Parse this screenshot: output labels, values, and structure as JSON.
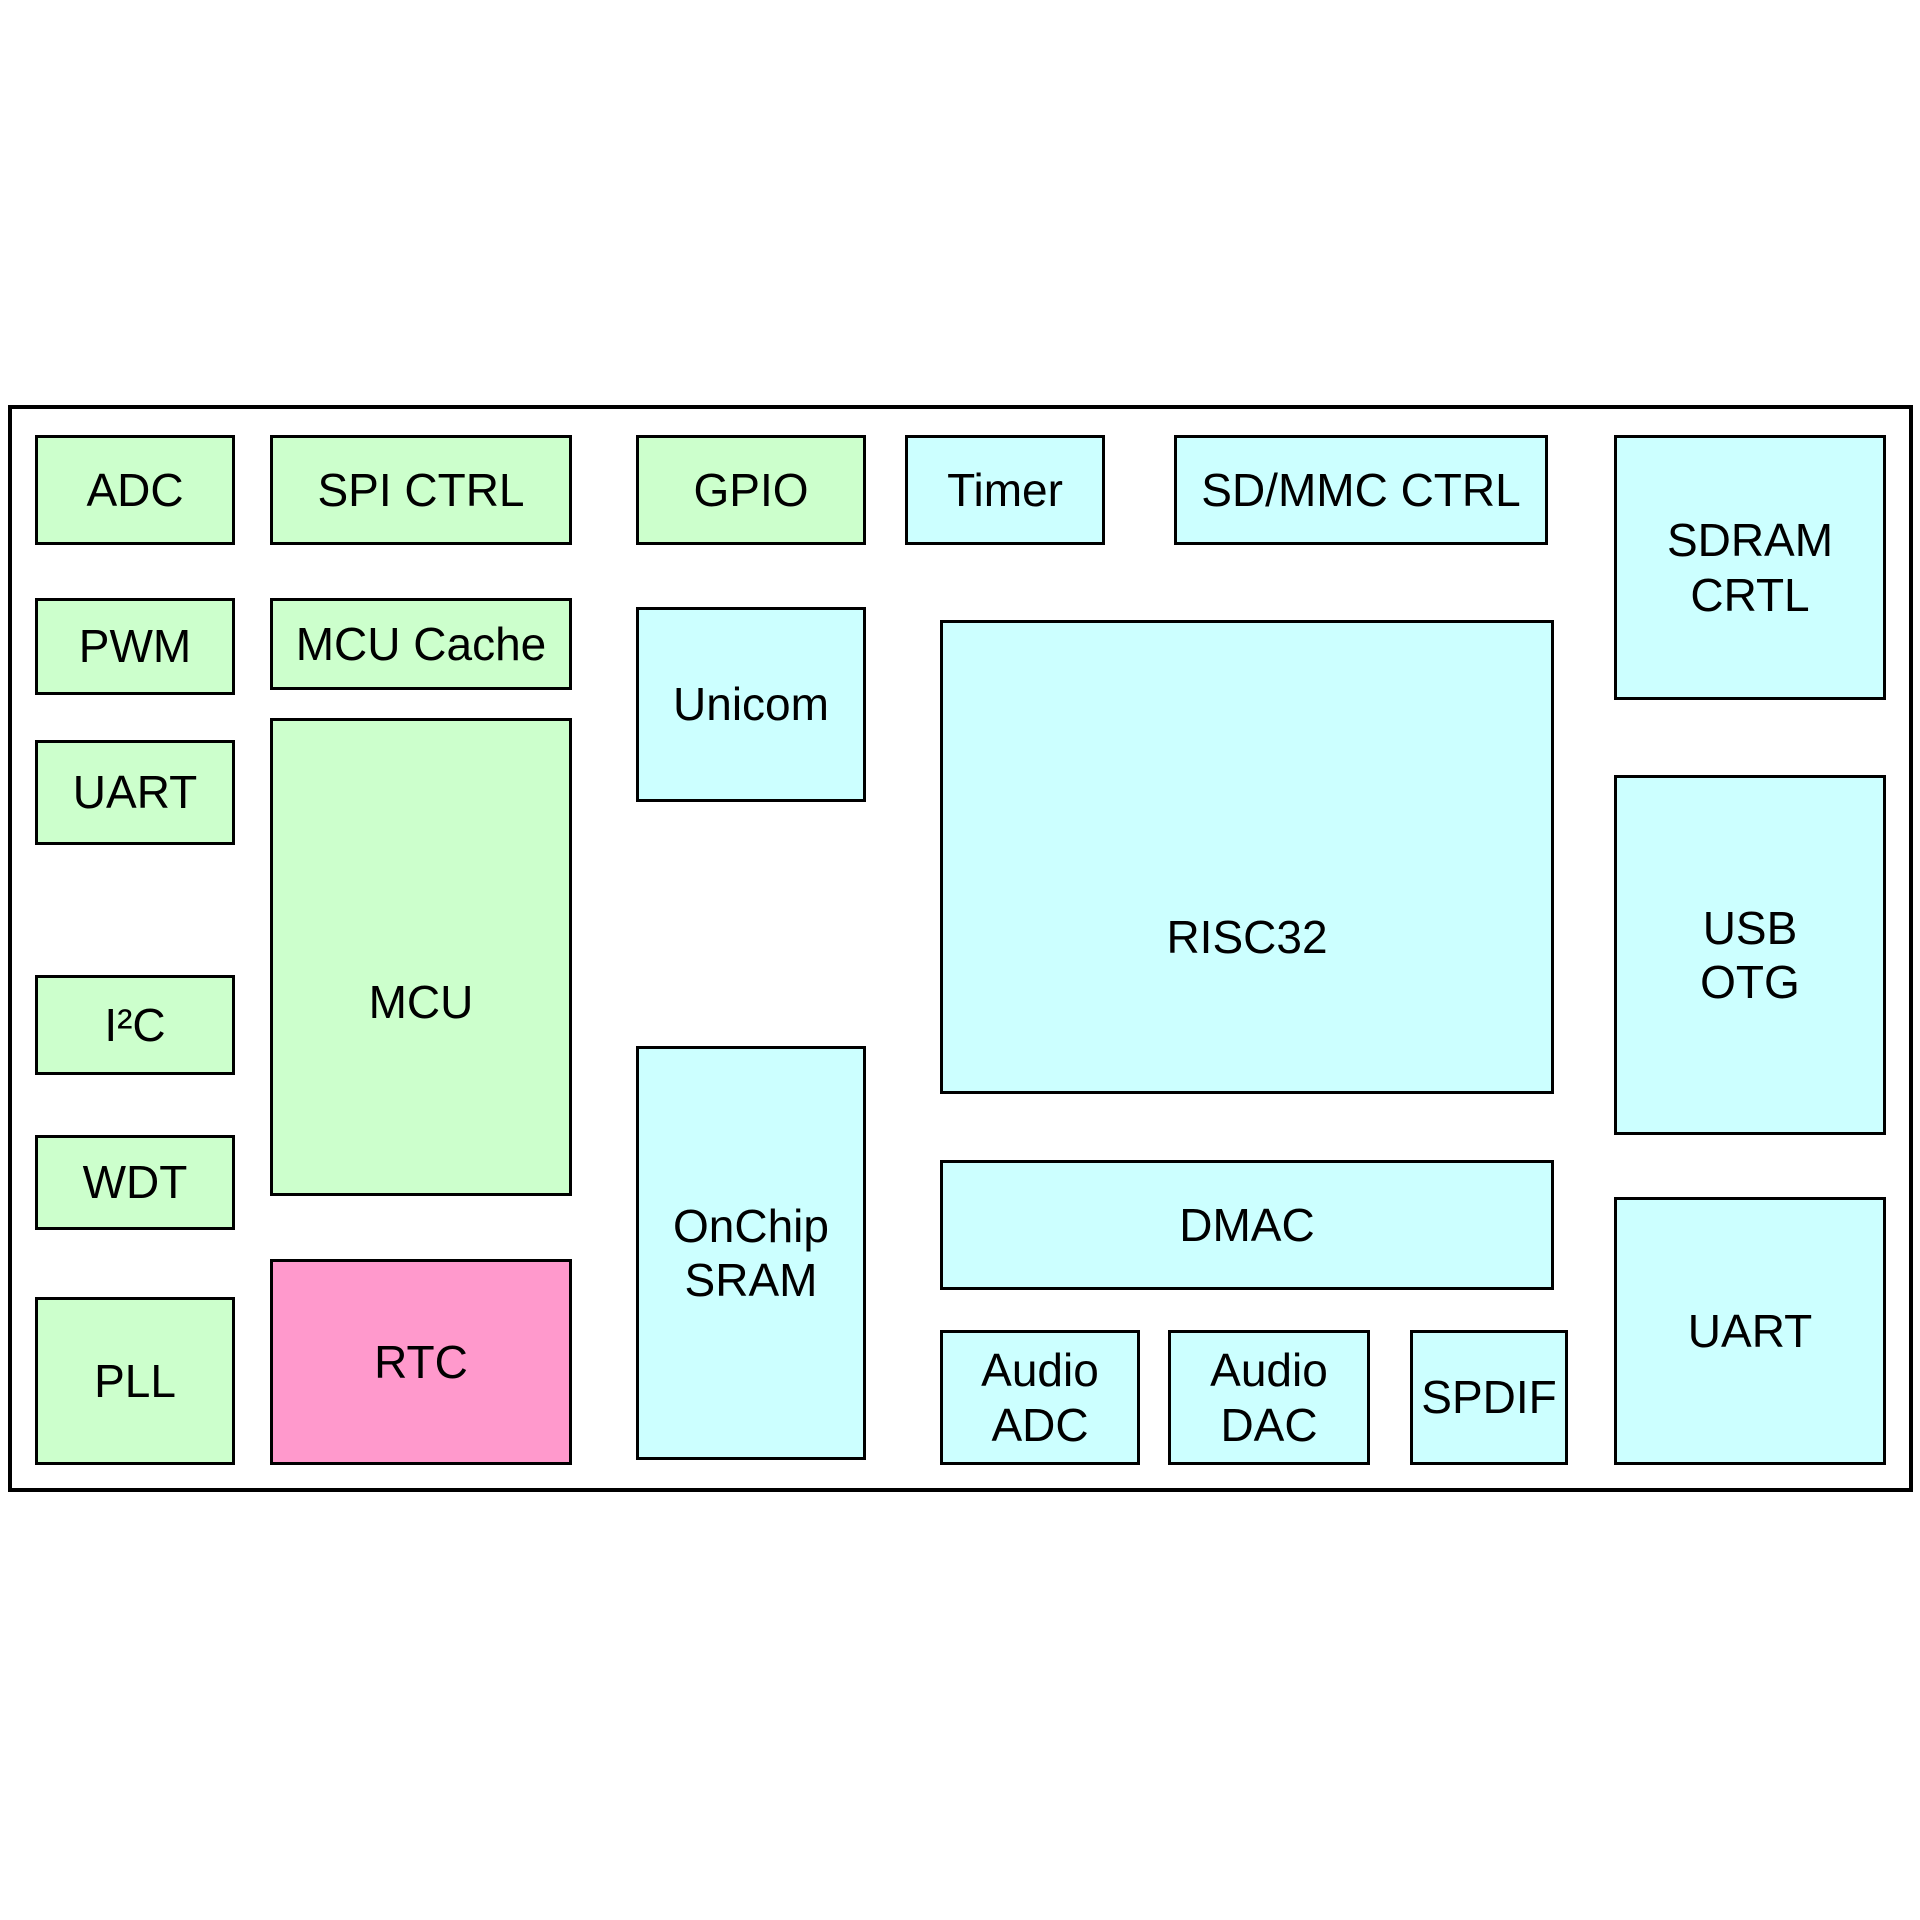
{
  "diagram": {
    "type": "soc-block-diagram",
    "background_color": "#ffffff",
    "outline_color": "#000000",
    "palette": {
      "green": "#ccffcc",
      "cyan": "#ccffff",
      "pink": "#ff99cc"
    },
    "blocks": [
      {
        "id": "adc",
        "label": "ADC",
        "color": "green",
        "x": 35,
        "y": 435,
        "w": 200,
        "h": 110
      },
      {
        "id": "spi-ctrl",
        "label": "SPI CTRL",
        "color": "green",
        "x": 270,
        "y": 435,
        "w": 302,
        "h": 110
      },
      {
        "id": "gpio",
        "label": "GPIO",
        "color": "green",
        "x": 636,
        "y": 435,
        "w": 230,
        "h": 110
      },
      {
        "id": "timer",
        "label": "Timer",
        "color": "cyan",
        "x": 905,
        "y": 435,
        "w": 200,
        "h": 110
      },
      {
        "id": "sd-mmc-ctrl",
        "label": "SD/MMC CTRL",
        "color": "cyan",
        "x": 1174,
        "y": 435,
        "w": 374,
        "h": 110
      },
      {
        "id": "sdram-crtl",
        "label": "SDRAM\nCRTL",
        "color": "cyan",
        "x": 1614,
        "y": 435,
        "w": 272,
        "h": 265
      },
      {
        "id": "pwm",
        "label": "PWM",
        "color": "green",
        "x": 35,
        "y": 598,
        "w": 200,
        "h": 97
      },
      {
        "id": "mcu-cache",
        "label": "MCU Cache",
        "color": "green",
        "x": 270,
        "y": 598,
        "w": 302,
        "h": 92
      },
      {
        "id": "unicom",
        "label": "Unicom",
        "color": "cyan",
        "x": 636,
        "y": 607,
        "w": 230,
        "h": 195
      },
      {
        "id": "risc32",
        "label": "RISC32",
        "color": "cyan",
        "x": 940,
        "y": 620,
        "w": 614,
        "h": 474
      },
      {
        "id": "uart-left",
        "label": "UART",
        "color": "green",
        "x": 35,
        "y": 740,
        "w": 200,
        "h": 105
      },
      {
        "id": "mcu",
        "label": "MCU",
        "color": "green",
        "x": 270,
        "y": 718,
        "w": 302,
        "h": 478
      },
      {
        "id": "usb-otg",
        "label": "USB\nOTG",
        "color": "cyan",
        "x": 1614,
        "y": 775,
        "w": 272,
        "h": 360
      },
      {
        "id": "i2c",
        "label": "I²C",
        "color": "green",
        "x": 35,
        "y": 975,
        "w": 200,
        "h": 100
      },
      {
        "id": "onchip-sram",
        "label": "OnChip\nSRAM",
        "color": "cyan",
        "x": 636,
        "y": 1046,
        "w": 230,
        "h": 414
      },
      {
        "id": "wdt",
        "label": "WDT",
        "color": "green",
        "x": 35,
        "y": 1135,
        "w": 200,
        "h": 95
      },
      {
        "id": "dmac",
        "label": "DMAC",
        "color": "cyan",
        "x": 940,
        "y": 1160,
        "w": 614,
        "h": 130
      },
      {
        "id": "uart-right",
        "label": "UART",
        "color": "cyan",
        "x": 1614,
        "y": 1197,
        "w": 272,
        "h": 268
      },
      {
        "id": "rtc",
        "label": "RTC",
        "color": "pink",
        "x": 270,
        "y": 1259,
        "w": 302,
        "h": 206
      },
      {
        "id": "pll",
        "label": "PLL",
        "color": "green",
        "x": 35,
        "y": 1297,
        "w": 200,
        "h": 168
      },
      {
        "id": "audio-adc",
        "label": "Audio\nADC",
        "color": "cyan",
        "x": 940,
        "y": 1330,
        "w": 200,
        "h": 135
      },
      {
        "id": "audio-dac",
        "label": "Audio\nDAC",
        "color": "cyan",
        "x": 1168,
        "y": 1330,
        "w": 202,
        "h": 135
      },
      {
        "id": "spdif",
        "label": "SPDIF",
        "color": "cyan",
        "x": 1410,
        "y": 1330,
        "w": 158,
        "h": 135
      }
    ]
  }
}
